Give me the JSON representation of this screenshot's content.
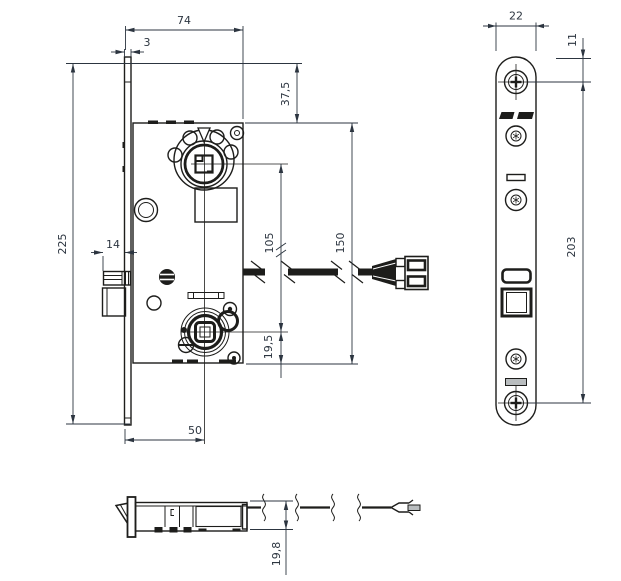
{
  "drawing": {
    "type": "technical-dimension-drawing",
    "subject": "mortise-lock-case-with-faceplate-and-cable-connector",
    "units_implied": "mm",
    "colors": {
      "line": "#1d1d1b",
      "dimension": "#2c3540",
      "background": "#ffffff",
      "slot_fill": "#b9bdbf"
    },
    "dims": {
      "case_width": "74",
      "faceplate_thickness": "3",
      "faceplate_height": "225",
      "case_top_offset": "37,5",
      "bolt_throw": "14",
      "follower_to_cylinder": "105",
      "case_height": "150",
      "cylinder_to_bottom": "19,5",
      "backset": "50",
      "plate_width": "22",
      "plate_top_to_screw": "11",
      "plate_screw_centers": "203",
      "case_depth": "19,8"
    }
  }
}
